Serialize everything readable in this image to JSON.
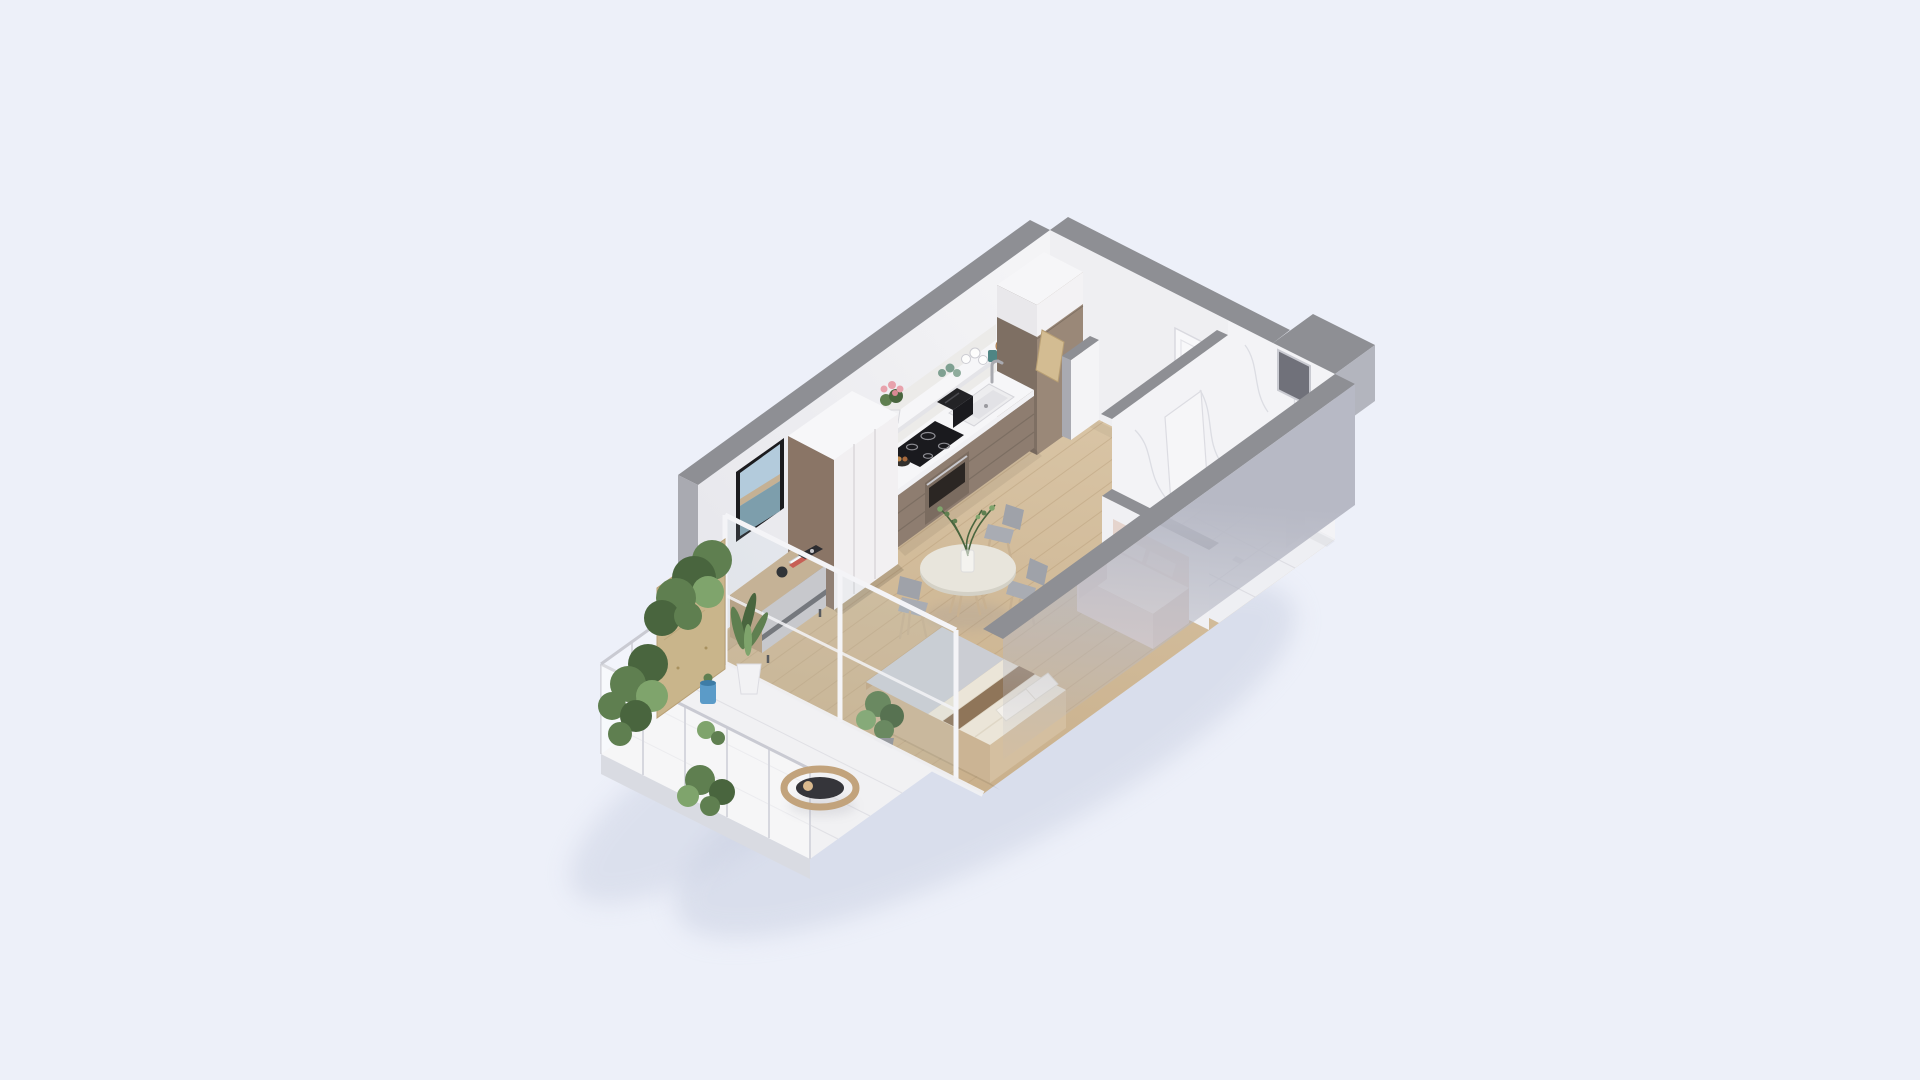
{
  "scene": {
    "type": "isometric-3d-floor-plan-render",
    "subject": "studio apartment cutaway with balcony",
    "view": "isometric from above, long axis running lower-left to upper-right",
    "rooms": [
      {
        "name": "living-bedroom",
        "floor": "light oak planks",
        "items": [
          "wall-mounted tv",
          "media console with speaker and books",
          "three-door wardrobe",
          "double platform bed with cream duvet, grey blanket, brown throw and two pillows",
          "potted floor plant"
        ]
      },
      {
        "name": "kitchen",
        "floor": "light oak planks",
        "items": [
          "tall cabinet with white upper box",
          "taupe base cabinets with white countertop",
          "double sink with faucet",
          "black induction cooktop",
          "built-in oven",
          "open shelf with glasses, cups, amber bowls and teal mug",
          "pink potted flowers",
          "black toaster",
          "leaning cutting board",
          "fruit bowl"
        ]
      },
      {
        "name": "dining",
        "items": [
          "round pedestal table",
          "glass vase with green branches",
          "three grey chairs with wooden legs"
        ]
      },
      {
        "name": "bathroom",
        "floor": "white marble tile",
        "items": [
          "tall marble partition wall",
          "leaning shower screen",
          "toilet",
          "washbasin"
        ]
      },
      {
        "name": "entry-hall",
        "items": [
          "white entrance door with handle",
          "marble accent end wall",
          "recessed window opening",
          "low stub wall"
        ]
      },
      {
        "name": "balcony",
        "floor": "white tile slab",
        "items": [
          "plywood privacy panel",
          "wire-mesh railing",
          "cascading potted plants",
          "tall leafy plant in white pot",
          "small blue pot",
          "curved wooden lounge chair"
        ]
      },
      {
        "name": "lounge",
        "items": [
          "blush two-seat sofa with cushions"
        ]
      }
    ],
    "structure": [
      "grey wall caps",
      "white inner wall faces",
      "large light-grey front wall face",
      "stepped outer wall recess at right corner",
      "glass balcony wall with white posts"
    ]
  },
  "palette": {
    "bg": "#EDF0F9",
    "shadow": "#C7CEE0",
    "wallCap": "#8E8F94",
    "wallCapLight": "#A9AAB1",
    "wallEnd": "#B3B5BE",
    "wallInner": "#F4F4F6",
    "wallInnerDeep": "#E7E7EC",
    "endWall": "#EFEFF2",
    "frontWall": "#B7B9C5",
    "floorWood": "#D9C5A6",
    "floorWoodDeep": "#C9B08C",
    "plank": "#B89E79",
    "marble": "#F3F3F6",
    "marbleVein": "#D7D8DF",
    "marbleFloor": "#EEEFF3",
    "cabinet": "#8E7D70",
    "cabinetDeep": "#74665B",
    "counter": "#F6F6F8",
    "tallCabinet": "#9A8878",
    "wardrobeDoor": "#F2F0F2",
    "wardrobeSide": "#8A7566",
    "woodFurniture": "#C7AD8C",
    "consoleFront": "#C9C7CA",
    "appliance": "#1A1A1E",
    "oven": "#7B6C60",
    "tvScreenSky": "#B3CBDC",
    "tvScreenSea": "#7D9EAC",
    "tvScreenLand": "#C6AE8C",
    "bedWood": "#CBB494",
    "duvet": "#EBE5D8",
    "blanket": "#CBCDD3",
    "throw": "#8A6F52",
    "pillow": "#F4F1EC",
    "sofa": "#E5D4CD",
    "sofaLight": "#F0E5DF",
    "tableTop": "#E8E5DC",
    "chairSeat": "#A9ACB3",
    "chairWood": "#C8B191",
    "plantDark": "#49653E",
    "plant": "#5F7F50",
    "plantLight": "#7FA46C",
    "plywood": "#C9B58B",
    "bluePot": "#5B9BC8",
    "terrace": "#F1F1F3",
    "railing": "#D6D7DE",
    "door": "#F8F8FA",
    "glass": "#BFD4E0",
    "teal": "#4F8584",
    "amber": "#C89A6B",
    "flower": "#E8A2AC"
  }
}
